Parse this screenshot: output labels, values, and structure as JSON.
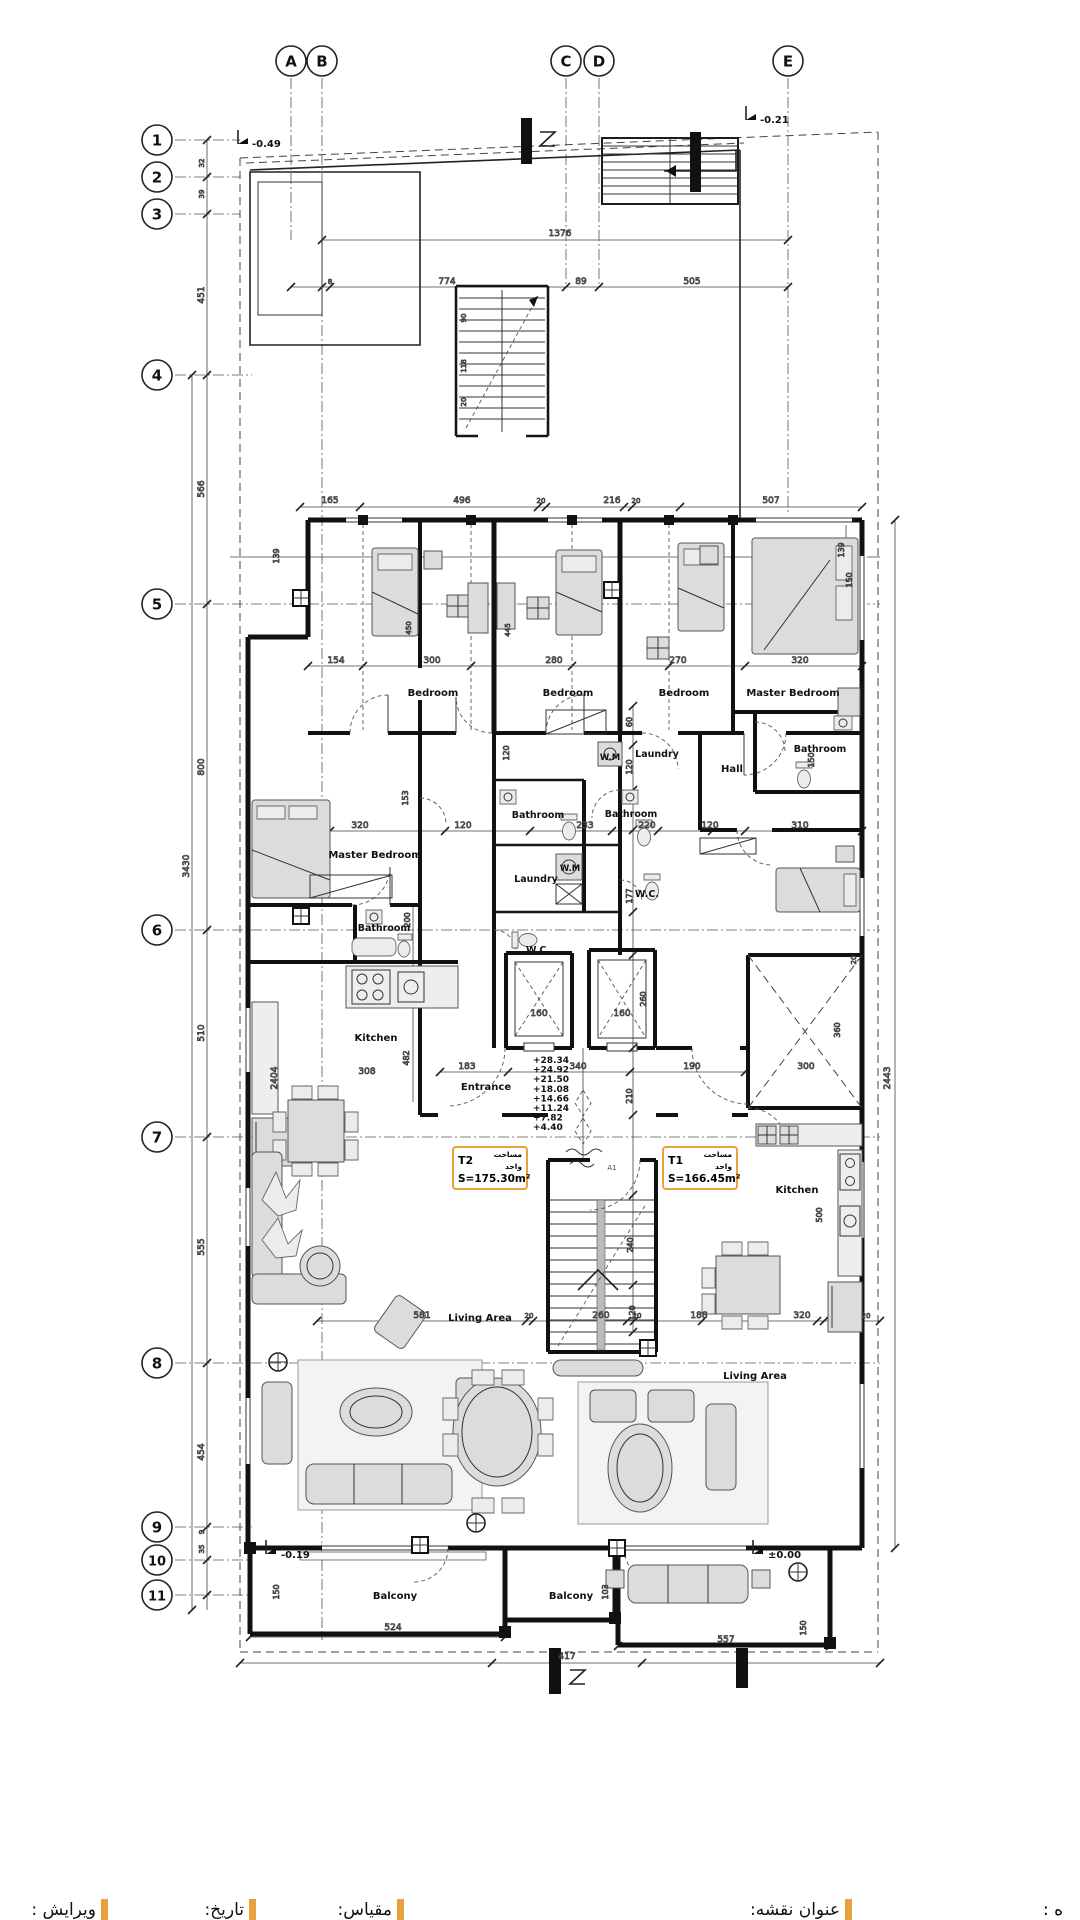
{
  "colors": {
    "accent_orange": "#E8A23C",
    "line": "#111111",
    "background": "#ffffff"
  },
  "grid": {
    "column_y": 61,
    "row_x": 157,
    "columns": [
      {
        "label": "A",
        "x": 291
      },
      {
        "label": "B",
        "x": 322
      },
      {
        "label": "C",
        "x": 566
      },
      {
        "label": "D",
        "x": 599
      },
      {
        "label": "E",
        "x": 788
      }
    ],
    "rows": [
      {
        "label": "1",
        "y": 140
      },
      {
        "label": "2",
        "y": 177
      },
      {
        "label": "3",
        "y": 214
      },
      {
        "label": "4",
        "y": 375
      },
      {
        "label": "5",
        "y": 604
      },
      {
        "label": "6",
        "y": 930
      },
      {
        "label": "7",
        "y": 1137
      },
      {
        "label": "8",
        "y": 1363
      },
      {
        "label": "9",
        "y": 1527
      },
      {
        "label": "10",
        "y": 1560
      },
      {
        "label": "11",
        "y": 1595
      }
    ]
  },
  "core_levels": {
    "x": 533,
    "y_start": 1063,
    "line_height": 9.6,
    "items": [
      "+28.34",
      "+24.92",
      "+21.50",
      "+18.08",
      "+14.66",
      "+11.24",
      "+7.82",
      "+4.40"
    ]
  },
  "units": [
    {
      "name": "T2",
      "area_label_fa": "مساحت واحد",
      "area": "S=175.30m²",
      "x": 452,
      "y": 1146
    },
    {
      "name": "T1",
      "area_label_fa": "مساحت واحد",
      "area": "S=166.45m²",
      "x": 662,
      "y": 1146
    }
  ],
  "plan_texts": [
    {
      "t": "1376",
      "x": 560,
      "y": 236
    },
    {
      "t": "8",
      "x": 330,
      "y": 284,
      "s": 7
    },
    {
      "t": "774",
      "x": 447,
      "y": 284
    },
    {
      "t": "89",
      "x": 581,
      "y": 284
    },
    {
      "t": "505",
      "x": 692,
      "y": 284
    },
    {
      "t": "165",
      "x": 330,
      "y": 503
    },
    {
      "t": "496",
      "x": 462,
      "y": 503
    },
    {
      "t": "20",
      "x": 541,
      "y": 503,
      "s": 7
    },
    {
      "t": "216",
      "x": 612,
      "y": 503
    },
    {
      "t": "20",
      "x": 636,
      "y": 503,
      "s": 7
    },
    {
      "t": "507",
      "x": 771,
      "y": 503
    },
    {
      "t": "32",
      "x": 204,
      "y": 163,
      "r": -90,
      "s": 7
    },
    {
      "t": "39",
      "x": 204,
      "y": 194,
      "r": -90,
      "s": 7
    },
    {
      "t": "451",
      "x": 204,
      "y": 295,
      "r": -90
    },
    {
      "t": "566",
      "x": 204,
      "y": 489,
      "r": -90
    },
    {
      "t": "800",
      "x": 204,
      "y": 767,
      "r": -90
    },
    {
      "t": "3430",
      "x": 189,
      "y": 866,
      "r": -90
    },
    {
      "t": "510",
      "x": 204,
      "y": 1033,
      "r": -90
    },
    {
      "t": "555",
      "x": 204,
      "y": 1247,
      "r": -90
    },
    {
      "t": "454",
      "x": 204,
      "y": 1452,
      "r": -90
    },
    {
      "t": "9",
      "x": 204,
      "y": 1532,
      "r": -90,
      "s": 7
    },
    {
      "t": "35",
      "x": 204,
      "y": 1549,
      "r": -90,
      "s": 7
    },
    {
      "t": "139",
      "x": 279,
      "y": 556,
      "r": -90,
      "s": 8
    },
    {
      "t": "139",
      "x": 844,
      "y": 550,
      "r": -90,
      "s": 8
    },
    {
      "t": "150",
      "x": 852,
      "y": 580,
      "r": -90,
      "s": 8
    },
    {
      "t": "90",
      "x": 466,
      "y": 318,
      "r": -90,
      "s": 7
    },
    {
      "t": "118",
      "x": 466,
      "y": 366,
      "r": -90,
      "s": 7
    },
    {
      "t": "20",
      "x": 466,
      "y": 402,
      "r": -90,
      "s": 7
    },
    {
      "t": "154",
      "x": 336,
      "y": 663
    },
    {
      "t": "300",
      "x": 432,
      "y": 663
    },
    {
      "t": "280",
      "x": 554,
      "y": 663
    },
    {
      "t": "270",
      "x": 678,
      "y": 663
    },
    {
      "t": "320",
      "x": 800,
      "y": 663
    },
    {
      "t": "450",
      "x": 411,
      "y": 628,
      "r": -90,
      "s": 7
    },
    {
      "t": "445",
      "x": 510,
      "y": 630,
      "r": -90,
      "s": 7
    },
    {
      "t": "120",
      "x": 509,
      "y": 753,
      "r": -90,
      "s": 8
    },
    {
      "t": "60",
      "x": 632,
      "y": 722,
      "r": -90,
      "s": 8
    },
    {
      "t": "120",
      "x": 632,
      "y": 767,
      "r": -90,
      "s": 8
    },
    {
      "t": "153",
      "x": 408,
      "y": 798,
      "r": -90,
      "s": 8
    },
    {
      "t": "150",
      "x": 814,
      "y": 760,
      "r": -90,
      "s": 8
    },
    {
      "t": "320",
      "x": 360,
      "y": 828
    },
    {
      "t": "120",
      "x": 463,
      "y": 828
    },
    {
      "t": "233",
      "x": 585,
      "y": 828
    },
    {
      "t": "220",
      "x": 647,
      "y": 828
    },
    {
      "t": "120",
      "x": 710,
      "y": 828
    },
    {
      "t": "310",
      "x": 800,
      "y": 828
    },
    {
      "t": "200",
      "x": 410,
      "y": 920,
      "r": -90,
      "s": 8
    },
    {
      "t": "177",
      "x": 632,
      "y": 896,
      "r": -90,
      "s": 8
    },
    {
      "t": "160",
      "x": 539,
      "y": 1016
    },
    {
      "t": "160",
      "x": 622,
      "y": 1016
    },
    {
      "t": "260",
      "x": 646,
      "y": 999,
      "r": -90,
      "s": 8
    },
    {
      "t": "183",
      "x": 467,
      "y": 1069
    },
    {
      "t": "340",
      "x": 578,
      "y": 1069
    },
    {
      "t": "190",
      "x": 692,
      "y": 1069
    },
    {
      "t": "210",
      "x": 632,
      "y": 1096,
      "r": -90,
      "s": 8
    },
    {
      "t": "482",
      "x": 409,
      "y": 1058,
      "r": -90,
      "s": 8
    },
    {
      "t": "308",
      "x": 367,
      "y": 1074
    },
    {
      "t": "2404",
      "x": 277,
      "y": 1078,
      "r": -90
    },
    {
      "t": "2443",
      "x": 890,
      "y": 1078,
      "r": -90
    },
    {
      "t": "360",
      "x": 840,
      "y": 1030,
      "r": -90,
      "s": 8
    },
    {
      "t": "300",
      "x": 806,
      "y": 1069
    },
    {
      "t": "20",
      "x": 856,
      "y": 960,
      "r": -90,
      "s": 7
    },
    {
      "t": "500",
      "x": 822,
      "y": 1215,
      "r": -90,
      "s": 8
    },
    {
      "t": "240",
      "x": 633,
      "y": 1245,
      "r": -90,
      "s": 8
    },
    {
      "t": "120",
      "x": 635,
      "y": 1313,
      "r": -90,
      "s": 8
    },
    {
      "t": "581",
      "x": 422,
      "y": 1318
    },
    {
      "t": "20",
      "x": 529,
      "y": 1318,
      "s": 7
    },
    {
      "t": "260",
      "x": 601,
      "y": 1318
    },
    {
      "t": "20",
      "x": 637,
      "y": 1318,
      "s": 7
    },
    {
      "t": "188",
      "x": 699,
      "y": 1318
    },
    {
      "t": "320",
      "x": 802,
      "y": 1318
    },
    {
      "t": "20",
      "x": 866,
      "y": 1318,
      "s": 7
    },
    {
      "t": "524",
      "x": 393,
      "y": 1630
    },
    {
      "t": "417",
      "x": 567,
      "y": 1659
    },
    {
      "t": "557",
      "x": 726,
      "y": 1642
    },
    {
      "t": "103",
      "x": 608,
      "y": 1592,
      "r": -90,
      "s": 8
    },
    {
      "t": "150",
      "x": 279,
      "y": 1592,
      "r": -90,
      "s": 8
    },
    {
      "t": "150",
      "x": 806,
      "y": 1628,
      "r": -90,
      "s": 8
    },
    {
      "t": "Bedroom",
      "x": 433,
      "y": 696,
      "c": "room",
      "s": 10
    },
    {
      "t": "Bedroom",
      "x": 568,
      "y": 696,
      "c": "room",
      "s": 10
    },
    {
      "t": "Bedroom",
      "x": 684,
      "y": 696,
      "c": "room",
      "s": 10
    },
    {
      "t": "Master Bedroom",
      "x": 793,
      "y": 696,
      "c": "room",
      "s": 10
    },
    {
      "t": "Master Bedroom",
      "x": 375,
      "y": 858,
      "c": "room",
      "s": 10
    },
    {
      "t": "Bathroom",
      "x": 384,
      "y": 931,
      "c": "room",
      "s": 9.5
    },
    {
      "t": "Bathroom",
      "x": 538,
      "y": 818,
      "c": "room",
      "s": 9.5
    },
    {
      "t": "Bathroom",
      "x": 631,
      "y": 817,
      "c": "room",
      "s": 9.5
    },
    {
      "t": "Bathroom",
      "x": 820,
      "y": 752,
      "c": "room",
      "s": 9.5
    },
    {
      "t": "Laundry",
      "x": 536,
      "y": 882,
      "c": "room",
      "s": 9.5
    },
    {
      "t": "Laundry",
      "x": 657,
      "y": 757,
      "c": "room",
      "s": 9.5
    },
    {
      "t": "W.M",
      "x": 570,
      "y": 871,
      "c": "room",
      "s": 8.5
    },
    {
      "t": "W.M",
      "x": 610,
      "y": 760,
      "c": "room",
      "s": 8.5
    },
    {
      "t": "W.C.",
      "x": 538,
      "y": 953,
      "c": "room",
      "s": 9.5
    },
    {
      "t": "W.C.",
      "x": 647,
      "y": 897,
      "c": "room",
      "s": 9.5
    },
    {
      "t": "Hall",
      "x": 732,
      "y": 772,
      "c": "room",
      "s": 10
    },
    {
      "t": "Kitchen",
      "x": 376,
      "y": 1041,
      "c": "room",
      "s": 10
    },
    {
      "t": "Kitchen",
      "x": 797,
      "y": 1193,
      "c": "room",
      "s": 10
    },
    {
      "t": "Entrance",
      "x": 486,
      "y": 1090,
      "c": "room",
      "s": 10
    },
    {
      "t": "Living Area",
      "x": 480,
      "y": 1321,
      "c": "room",
      "s": 10
    },
    {
      "t": "Living Area",
      "x": 755,
      "y": 1379,
      "c": "room",
      "s": 10
    },
    {
      "t": "Balcony",
      "x": 395,
      "y": 1599,
      "c": "room",
      "s": 10
    },
    {
      "t": "Balcony",
      "x": 571,
      "y": 1599,
      "c": "room",
      "s": 10
    },
    {
      "t": "-0.49",
      "x": 252,
      "y": 147,
      "c": "marker",
      "s": 10,
      "a": "start"
    },
    {
      "t": "-0.21",
      "x": 760,
      "y": 123,
      "c": "marker",
      "s": 10,
      "a": "start"
    },
    {
      "t": "-0.19",
      "x": 281,
      "y": 1558,
      "c": "marker",
      "s": 10,
      "a": "start"
    },
    {
      "t": "±0.00",
      "x": 768,
      "y": 1558,
      "c": "marker",
      "s": 10,
      "a": "start"
    },
    {
      "t": "A1",
      "x": 612,
      "y": 1170,
      "s": 7,
      "c": "note"
    }
  ],
  "title_bar": {
    "partial_right_label": "ه :",
    "fields": [
      {
        "label": "عنوان نقشه:",
        "tick_x": 845
      },
      {
        "label": "مقیاس:",
        "tick_x": 397
      },
      {
        "label": "تاریخ:",
        "tick_x": 249
      },
      {
        "label": "ویرایش :",
        "tick_x": 101
      }
    ]
  }
}
